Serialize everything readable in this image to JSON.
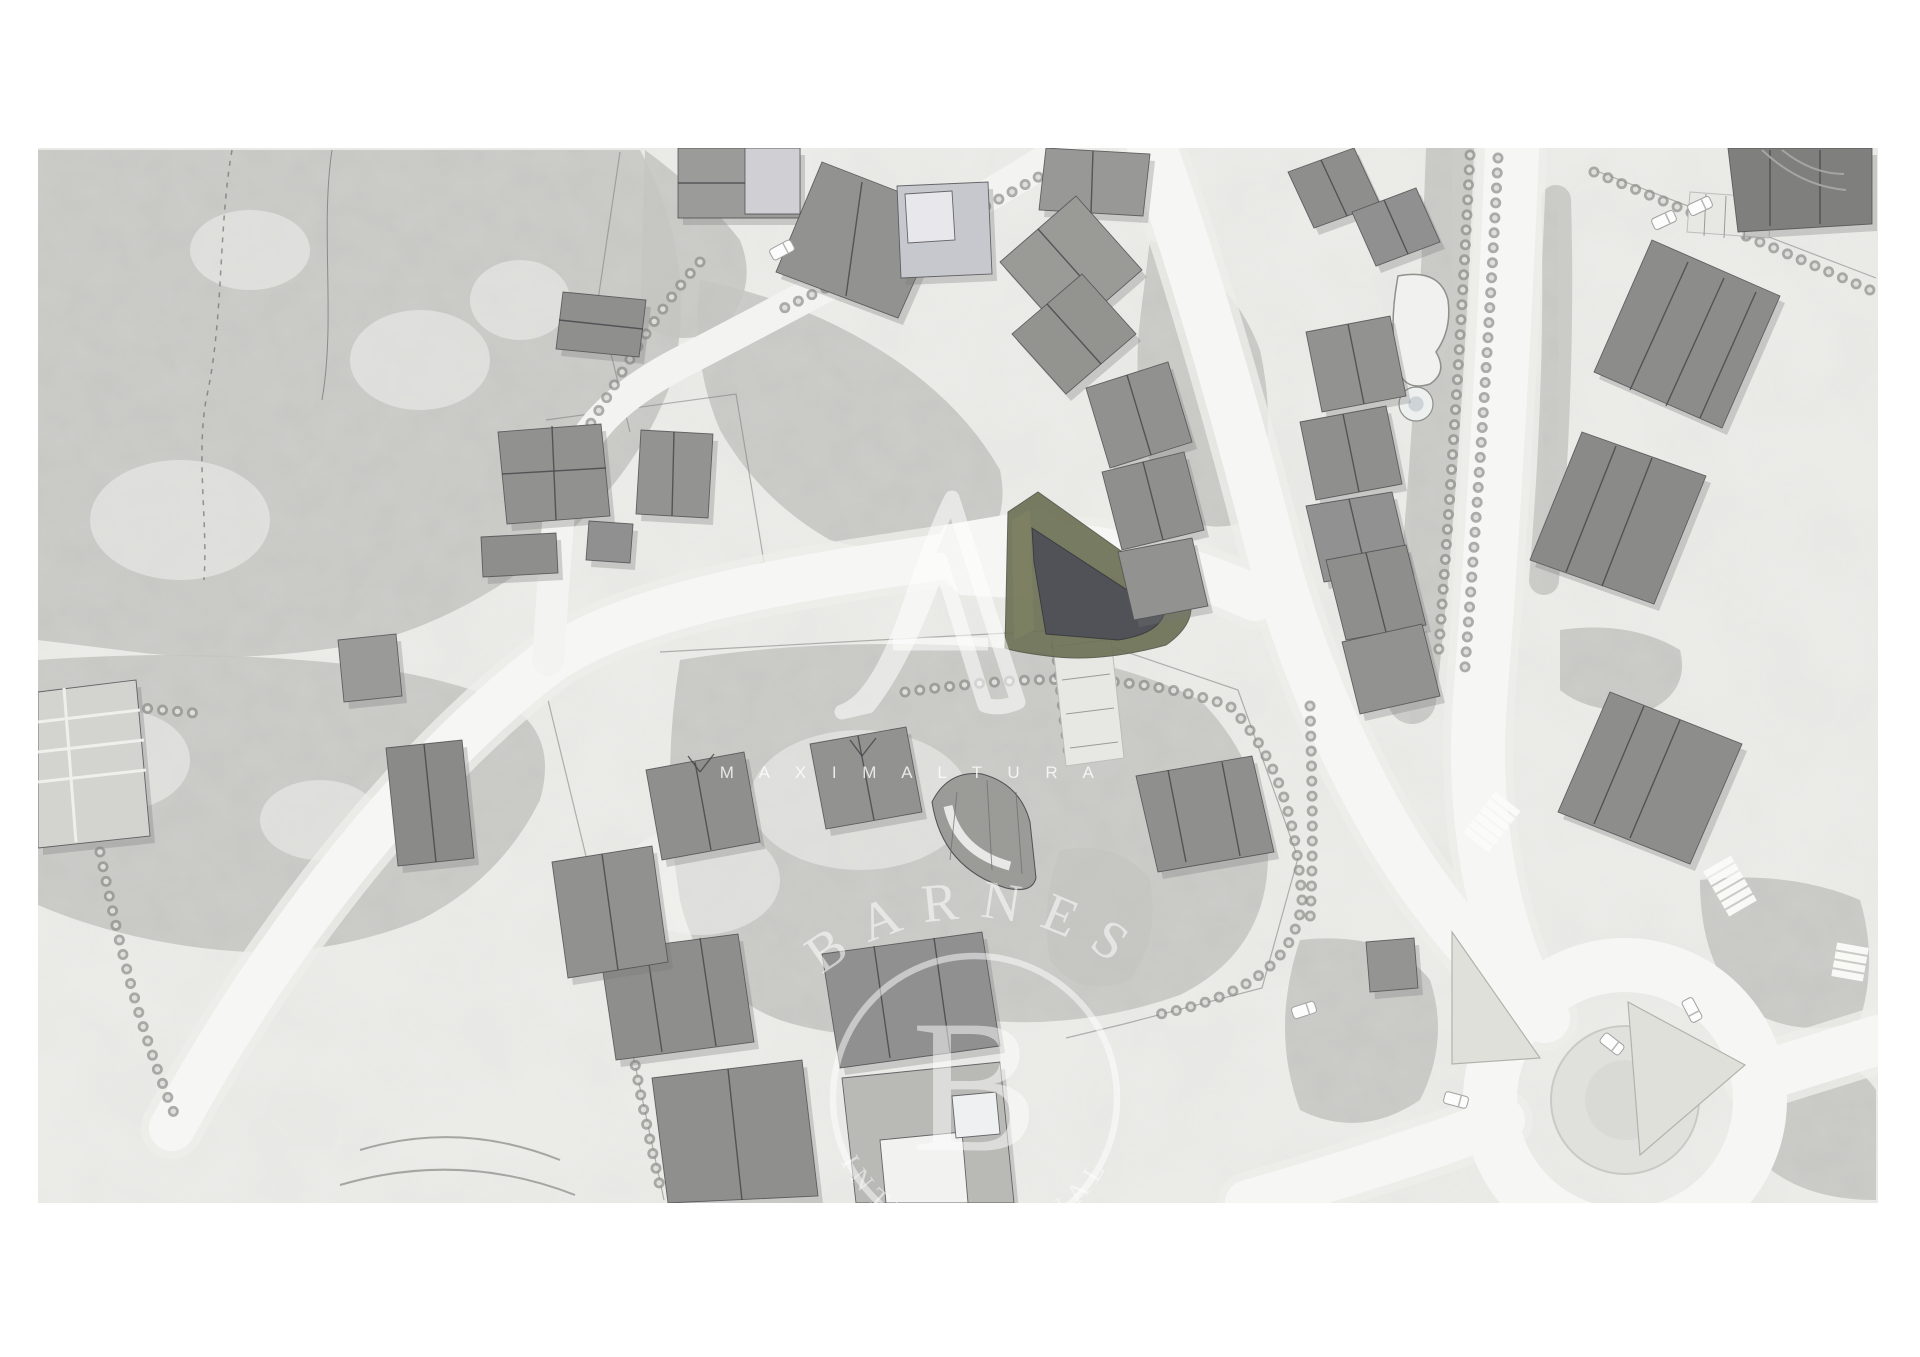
{
  "page": {
    "bg": "#ffffff",
    "map_bg": "#ebebe8",
    "frame": {
      "x": 38,
      "y": 148,
      "w": 1840,
      "h": 1055
    }
  },
  "palette": {
    "road": "#f6f6f4",
    "road_shoulder": "#ededea",
    "driveway": "#f3f3f1",
    "forest_base": "#c6c6c2",
    "building_stroke": "#515155",
    "ridge": "#45454a",
    "shadow": "#787876",
    "tree_dot": "#8c8c89",
    "tree_dot_inner": "#e4e4e1",
    "site_olive": "#6d7155",
    "site_olive_light": "#7e8264",
    "site_dark": "#515257",
    "watermark": "#ffffff",
    "grass_island": "#dfe0da",
    "island_fill": "#e0e0dd"
  },
  "watermarks": {
    "maximaltura": {
      "monogram": "A",
      "wordmark": "M A X I M A L T U R A"
    },
    "barnes": {
      "wordmark": "BARNES",
      "monogram": "B",
      "subtitle": "INTERNATIONAL"
    }
  },
  "features": {
    "forests": [
      {
        "d": "M38,150 L640,150 Q700,260 672,380 Q640,470 560,540 Q480,610 380,640 Q240,668 120,650 L38,640 Z"
      },
      {
        "d": "M38,660 Q180,650 300,660 Q420,668 500,700 Q560,730 540,800 Q500,880 420,920 Q320,960 220,950 Q120,940 38,905 Z"
      },
      {
        "d": "M700,280 Q800,300 880,350 Q960,400 1000,470 Q1010,520 980,545 Q900,560 830,540 Q760,500 720,430 Q690,360 700,280 Z"
      },
      {
        "d": "M680,660 Q800,640 950,645 Q1100,650 1200,700 Q1260,760 1268,850 Q1270,950 1180,995 Q1080,1030 980,1020 Q870,1050 780,1020 Q700,990 680,900 Q660,780 680,660 Z"
      },
      {
        "d": "M645,150 Q700,190 740,240 Q760,290 720,330 Q670,350 640,320 Z"
      },
      {
        "d": "M1150,240 Q1230,270 1260,350 Q1280,440 1250,520 Q1200,540 1160,500 Q1130,400 1140,320 Z"
      },
      {
        "d": "M1700,880 Q1790,870 1860,900 Q1878,960 1860,1020 Q1800,1040 1750,1010 Q1700,970 1700,880 Z"
      },
      {
        "d": "M1780,1060 Q1850,1050 1876,1090 L1876,1200 Q1800,1200 1760,1160 Q1740,1100 1780,1060 Z"
      },
      {
        "d": "M1300,940 Q1390,930 1430,980 Q1450,1040 1420,1100 Q1360,1140 1300,1110 Q1270,1030 1300,940 Z"
      },
      {
        "d": "M1560,630 Q1630,620 1680,650 Q1690,690 1650,710 Q1590,715 1560,690 Z"
      },
      {
        "d": "M1060,850 Q1120,840 1150,880 Q1160,940 1130,980 Q1080,1000 1050,960 Q1040,900 1060,850 Z"
      }
    ],
    "forest_bands": [
      {
        "d": "M1450,150 C1444,320 1432,520 1412,700",
        "sw": 48
      },
      {
        "d": "M1556,200 C1560,330 1554,460 1544,580",
        "sw": 30
      }
    ],
    "light_patches": [
      {
        "cx": 180,
        "cy": 520,
        "rx": 90,
        "ry": 60
      },
      {
        "cx": 420,
        "cy": 360,
        "rx": 70,
        "ry": 50
      },
      {
        "cx": 250,
        "cy": 250,
        "rx": 60,
        "ry": 40
      },
      {
        "cx": 120,
        "cy": 760,
        "rx": 70,
        "ry": 50
      },
      {
        "cx": 320,
        "cy": 820,
        "rx": 60,
        "ry": 40
      },
      {
        "cx": 520,
        "cy": 300,
        "rx": 50,
        "ry": 40
      },
      {
        "cx": 860,
        "cy": 800,
        "rx": 110,
        "ry": 70
      },
      {
        "cx": 700,
        "cy": 880,
        "rx": 80,
        "ry": 55
      }
    ],
    "boundaries": [
      {
        "d": "M660,652 L1062,630 L1238,690 L1298,858 L1262,988 L1124,1024 L1066,1038"
      },
      {
        "d": "M546,420 L736,394 L764,562 L702,584"
      },
      {
        "d": "M1594,170 L1876,278"
      },
      {
        "d": "M548,700 L622,1004 L664,1200"
      },
      {
        "d": "M620,152 L598,300 L630,432"
      }
    ],
    "trails": [
      {
        "d": "M232,150 C218,230 224,320 206,400 C196,460 208,520 204,580",
        "dash": "5 6",
        "sw": 1.5
      },
      {
        "d": "M332,150 C320,230 336,320 322,400",
        "dash": "",
        "sw": 1
      }
    ],
    "roads": [
      {
        "d": "M172,1128 C280,930 420,760 548,662 C640,598 820,574 1002,548 C1080,538 1170,560 1255,598",
        "w": 46
      },
      {
        "d": "M1152,148 C1192,260 1238,420 1270,545 C1302,668 1362,802 1428,892 C1472,952 1512,992 1545,1018",
        "w": 50
      },
      {
        "d": "M1512,150 C1506,300 1494,520 1480,700 C1472,800 1488,900 1518,972",
        "w": 54
      },
      {
        "d": "M1502,1120 C1420,1152 1320,1182 1248,1203",
        "w": 46
      },
      {
        "d": "M1756,1078 L1878,1040",
        "w": 50
      }
    ],
    "driveways": [
      {
        "d": "M1062,150 C960,216 820,290 678,364 C610,400 572,440 560,505 C554,560 552,610 548,660",
        "w": 32
      }
    ],
    "junction_patches": [
      {
        "pts": "945,525 1045,508 1090,545 1050,600 960,595 925,560"
      }
    ],
    "roundabout": {
      "cx": 1625,
      "cy": 1100,
      "outer_r": 135,
      "ring_w": 54,
      "island_r": 74,
      "island_core_r": 40,
      "grass_triangles": [
        {
          "pts": "1452,932 1540,1058 1452,1064"
        },
        {
          "pts": "1628,1002 1745,1065 1640,1155"
        }
      ]
    },
    "treelines": [
      {
        "d": "M700,262 C640,330 610,400 560,470"
      },
      {
        "d": "M1064,162 C980,212 880,262 780,310"
      },
      {
        "d": "M905,692 C1010,678 1120,668 1230,706 C1280,760 1296,820 1302,900"
      },
      {
        "d": "M1302,900 C1296,965 1240,1000 1150,1016"
      },
      {
        "d": "M58,700 L205,714"
      },
      {
        "d": "M100,852 C120,950 140,1030 176,1118"
      },
      {
        "d": "M1470,155 C1462,320 1450,500 1438,660"
      },
      {
        "d": "M1498,158 C1490,320 1478,500 1464,680"
      },
      {
        "d": "M1594,172 C1690,212 1780,250 1870,290"
      },
      {
        "d": "M626,1006 C636,1080 650,1140 662,1196"
      },
      {
        "d": "M1310,706 C1312,780 1314,850 1310,920"
      },
      {
        "d": "M1050,586 C1056,650 1062,710 1070,762"
      }
    ],
    "parkings": [
      {
        "pts": "1046,582 1104,574 1124,758 1066,766",
        "ticks": [
          [
            1054,
            612,
            1102,
            606
          ],
          [
            1058,
            646,
            1106,
            640
          ],
          [
            1062,
            680,
            1110,
            674
          ],
          [
            1066,
            714,
            1114,
            708
          ],
          [
            1070,
            748,
            1118,
            742
          ]
        ]
      },
      {
        "pts": "1690,192 1772,198 1769,238 1687,232",
        "ticks": [
          [
            1706,
            194,
            1704,
            236
          ],
          [
            1726,
            196,
            1724,
            238
          ],
          [
            1746,
            197,
            1744,
            239
          ]
        ]
      }
    ],
    "site": {
      "outer": "M1005,648 L1008,512 L1038,492 L1190,600 Q1196,624 1166,645 Q1100,663 1048,656 Q1016,652 1005,648 Z",
      "terrace": "M1012,520 L1030,510 L1034,630 L1014,640 Z",
      "inner": "M1032,528 L1164,614 Q1158,634 1118,640 L1046,634 L1034,562 Z"
    },
    "ponds": [
      {
        "d": "M1398,276 Q1440,268 1448,300 Q1452,330 1436,352 Q1448,372 1430,384 Q1404,392 1398,368 Q1388,330 1398,276 Z"
      }
    ],
    "pond_circles": [
      {
        "cx": 1416,
        "cy": 404,
        "r": 17
      }
    ],
    "buildings": [
      {
        "pts": "678,148 800,148 800,218 678,218",
        "fill": "#9b9b99",
        "lines": [
          [
            678,
            183,
            800,
            183
          ]
        ]
      },
      {
        "pts": "745,148 800,148 800,214 745,214",
        "fill": "#cfcfd4",
        "lines": [],
        "noshadow": true
      },
      {
        "pts": "822,162 946,210 898,318 776,272",
        "fill": "#929290",
        "lines": [
          [
            862,
            182,
            846,
            296
          ]
        ]
      },
      {
        "pts": "897,186 988,182 992,274 901,278",
        "fill": "#c7c7ce",
        "lines": []
      },
      {
        "pts": "905,194 952,191 955,240 908,243",
        "fill": "#e8e8ec",
        "lines": [],
        "noshadow": true
      },
      {
        "pts": "563,292 646,300 639,357 556,349",
        "fill": "#8f8f8d",
        "lines": [
          [
            559,
            320,
            643,
            329
          ]
        ]
      },
      {
        "pts": "498,432 601,424 610,516 507,524",
        "fill": "#919190",
        "lines": [
          [
            502,
            474,
            606,
            468
          ],
          [
            552,
            426,
            556,
            520
          ]
        ]
      },
      {
        "pts": "641,430 713,434 708,518 636,514",
        "fill": "#939391",
        "lines": [
          [
            674,
            432,
            672,
            516
          ]
        ]
      },
      {
        "pts": "481,537 556,533 558,573 483,577",
        "fill": "#8e8e8c",
        "lines": []
      },
      {
        "pts": "589,521 633,524 630,563 586,560",
        "fill": "#909090",
        "lines": []
      },
      {
        "pts": "1046,148 1150,154 1143,216 1039,210",
        "fill": "#989896",
        "lines": [
          [
            1093,
            151,
            1091,
            213
          ]
        ]
      },
      {
        "pts": "1000,262 1076,196 1142,270 1066,336",
        "fill": "#9a9a97",
        "lines": [
          [
            1038,
            229,
            1104,
            303
          ]
        ]
      },
      {
        "pts": "1012,334 1082,274 1136,334 1066,394",
        "fill": "#93938f",
        "lines": [
          [
            1047,
            304,
            1101,
            364
          ]
        ]
      },
      {
        "pts": "1086,388 1168,362 1192,442 1110,468",
        "fill": "#919190",
        "lines": [
          [
            1127,
            375,
            1151,
            455
          ]
        ]
      },
      {
        "pts": "1102,472 1184,452 1204,530 1122,550",
        "fill": "#8f8f8d",
        "lines": [
          [
            1143,
            462,
            1163,
            540
          ]
        ]
      },
      {
        "pts": "1118,552 1192,538 1208,606 1134,620",
        "fill": "#929290",
        "lines": []
      },
      {
        "pts": "1288,172 1354,148 1380,204 1314,228",
        "fill": "#8e8e8c",
        "lines": [
          [
            1321,
            160,
            1347,
            216
          ]
        ]
      },
      {
        "pts": "1352,212 1416,188 1440,242 1376,266",
        "fill": "#909090",
        "lines": [
          [
            1384,
            200,
            1408,
            254
          ]
        ]
      },
      {
        "pts": "1306,332 1390,316 1406,396 1322,412",
        "fill": "#929290",
        "lines": [
          [
            1348,
            324,
            1364,
            404
          ]
        ]
      },
      {
        "pts": "1300,422 1386,406 1402,484 1316,500",
        "fill": "#8f8f8d",
        "lines": [
          [
            1343,
            414,
            1359,
            492
          ]
        ]
      },
      {
        "pts": "1306,506 1392,492 1410,568 1324,582",
        "fill": "#919191",
        "lines": [
          [
            1349,
            499,
            1367,
            575
          ]
        ]
      },
      {
        "pts": "1326,560 1406,545 1426,625 1346,640",
        "fill": "#8e8e8c",
        "lines": [
          [
            1366,
            553,
            1386,
            632
          ]
        ]
      },
      {
        "pts": "1342,642 1422,624 1440,696 1360,714",
        "fill": "#929290",
        "lines": []
      },
      {
        "pts": "1136,776 1252,756 1274,852 1158,872",
        "fill": "#8f8f8d",
        "lines": [
          [
            1168,
            770,
            1186,
            862
          ],
          [
            1222,
            762,
            1240,
            856
          ]
        ]
      },
      {
        "pts": "1366,942 1414,938 1418,988 1370,992",
        "fill": "#949492",
        "lines": []
      },
      {
        "pts": "1728,148 1872,148 1872,224 1738,232",
        "fill": "#7f7f7e",
        "lines": [
          [
            1770,
            150,
            1770,
            226
          ],
          [
            1820,
            150,
            1820,
            224
          ]
        ]
      },
      {
        "pts": "1652,240 1780,296 1722,428 1594,372",
        "fill": "#8c8c8a",
        "lines": [
          [
            1688,
            262,
            1630,
            390
          ],
          [
            1724,
            278,
            1666,
            406
          ],
          [
            1756,
            292,
            1700,
            418
          ]
        ]
      },
      {
        "pts": "1582,432 1706,476 1654,604 1530,560",
        "fill": "#8a8a88",
        "lines": [
          [
            1616,
            446,
            1566,
            572
          ],
          [
            1652,
            458,
            1602,
            586
          ]
        ]
      },
      {
        "pts": "1610,692 1742,744 1690,864 1558,812",
        "fill": "#8d8d8b",
        "lines": [
          [
            1644,
            706,
            1594,
            824
          ],
          [
            1680,
            720,
            1630,
            838
          ]
        ]
      },
      {
        "pts": "646,770 744,752 760,842 662,860",
        "fill": "#8f8f8d",
        "lines": [
          [
            695,
            762,
            711,
            850
          ],
          [
            688,
            756,
            700,
            772
          ],
          [
            700,
            772,
            714,
            754
          ]
        ]
      },
      {
        "pts": "810,744 906,727 922,812 826,829",
        "fill": "#929290",
        "lines": [
          [
            858,
            736,
            874,
            820
          ],
          [
            850,
            740,
            862,
            756
          ],
          [
            862,
            756,
            876,
            738
          ]
        ]
      },
      {
        "pts": "600,952 738,934 754,1042 616,1060",
        "fill": "#8e8e8c",
        "lines": [
          [
            646,
            944,
            662,
            1052
          ],
          [
            700,
            938,
            716,
            1046
          ]
        ]
      },
      {
        "pts": "822,954 982,932 1000,1046 840,1068",
        "fill": "#909090",
        "lines": [
          [
            874,
            946,
            890,
            1058
          ],
          [
            934,
            938,
            950,
            1052
          ]
        ]
      },
      {
        "pts": "652,1078 802,1060 818,1196 668,1203",
        "fill": "#8f8f8d",
        "lines": [
          [
            728,
            1069,
            742,
            1200
          ]
        ]
      },
      {
        "pts": "842,1078 1000,1062 1014,1203 856,1203",
        "fill": "#b9b9b6",
        "lines": []
      },
      {
        "pts": "880,1140 962,1132 968,1203 886,1203",
        "fill": "#f2f2f1",
        "lines": [],
        "noshadow": true
      },
      {
        "pts": "952,1096 996,1092 1000,1134 956,1138",
        "fill": "#eef0f2",
        "lines": [],
        "noshadow": true
      },
      {
        "pts": "552,862 652,846 668,962 568,978",
        "fill": "#919190",
        "lines": [
          [
            602,
            854,
            618,
            970
          ]
        ]
      },
      {
        "pts": "386,748 462,740 474,858 398,866",
        "fill": "#8a8a88",
        "lines": [
          [
            424,
            744,
            436,
            862
          ]
        ]
      },
      {
        "pts": "338,640 396,634 402,696 344,702",
        "fill": "#9a9a98",
        "lines": []
      },
      {
        "pts": "38,692 136,680 150,836 38,848",
        "fill": "#d3d3d0",
        "lines": []
      }
    ],
    "terrace_lines": [
      [
        38,
        722,
        140,
        710
      ],
      [
        38,
        752,
        144,
        740
      ],
      [
        38,
        782,
        146,
        770
      ],
      [
        64,
        688,
        76,
        842
      ]
    ],
    "fan_building": {
      "outline": "M932,802 Q942,868 1006,888 Q1032,894 1036,878 L1030,822 Q1020,784 982,774 Q948,770 932,802 Z",
      "fill": "#9b9b98",
      "arc": "M948,806 Q958,852 1010,866",
      "radials": [
        [
          957,
          792,
          950,
          860
        ],
        [
          987,
          780,
          992,
          870
        ],
        [
          1016,
          792,
          1022,
          874
        ]
      ]
    },
    "crosswalks": [
      {
        "cx": 1492,
        "cy": 822,
        "rot": 128,
        "n": 6
      },
      {
        "cx": 1730,
        "cy": 886,
        "rot": 60,
        "n": 6
      },
      {
        "cx": 1850,
        "cy": 962,
        "rot": 100,
        "n": 4
      }
    ],
    "cars": [
      {
        "cx": 782,
        "cy": 250,
        "rot": -28
      },
      {
        "cx": 1456,
        "cy": 1100,
        "rot": 15
      },
      {
        "cx": 1612,
        "cy": 1044,
        "rot": 38
      },
      {
        "cx": 1692,
        "cy": 1010,
        "rot": 62
      },
      {
        "cx": 1304,
        "cy": 1010,
        "rot": -18
      },
      {
        "cx": 1700,
        "cy": 206,
        "rot": -25
      },
      {
        "cx": 1664,
        "cy": 220,
        "rot": -25
      }
    ],
    "detail_arcs": [
      {
        "d": "M1762,150 Q1800,186 1846,190"
      },
      {
        "d": "M1782,150 Q1812,174 1844,174"
      },
      {
        "d": "M360,1150 Q460,1120 560,1160"
      },
      {
        "d": "M340,1185 Q460,1150 575,1195"
      }
    ]
  }
}
